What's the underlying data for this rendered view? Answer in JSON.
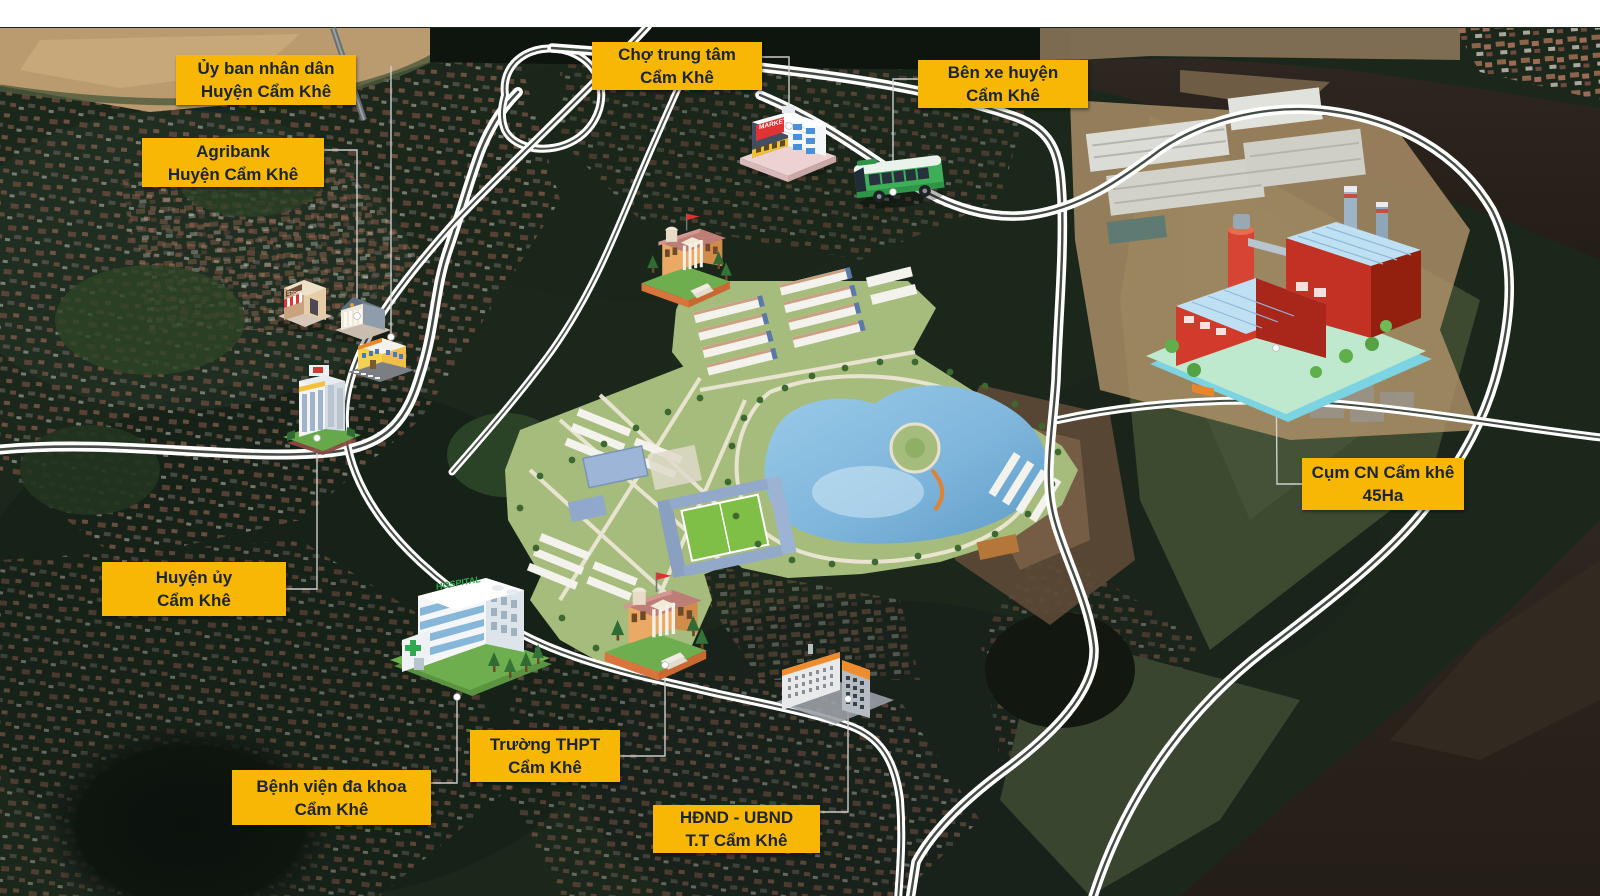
{
  "map_title": "Cẩm Khê landmarks satellite overview",
  "labels": [
    {
      "id": "uy-ban",
      "line1": "Ủy ban nhân dân",
      "line2": "Huyện Cẩm Khê"
    },
    {
      "id": "agribank",
      "line1": "Agribank",
      "line2": "Huyện Cẩm Khê"
    },
    {
      "id": "cho",
      "line1": "Chợ trung tâm",
      "line2": "Cẩm Khê"
    },
    {
      "id": "ben-xe",
      "line1": "Bên xe huyện",
      "line2": "Cẩm Khê"
    },
    {
      "id": "cum-cn",
      "line1": "Cụm CN Cẩm khê",
      "line2": "45Ha"
    },
    {
      "id": "huyen-uy",
      "line1": "Huyện ủy",
      "line2": "Cẩm Khê"
    },
    {
      "id": "benh-vien",
      "line1": "Bệnh viện đa khoa",
      "line2": "Cẩm Khê"
    },
    {
      "id": "truong",
      "line1": "Trường THPT",
      "line2": "Cẩm Khê"
    },
    {
      "id": "hdnd",
      "line1": "HĐND - UBND",
      "line2": "T.T Cẩm Khê"
    }
  ],
  "icon_texts": {
    "market": "MARKET",
    "hospital": "HOSPITAL",
    "store": "STORE"
  },
  "icons": [
    {
      "name": "store-icon"
    },
    {
      "name": "committee-building-icon"
    },
    {
      "name": "agribank-building-icon"
    },
    {
      "name": "office-tower-icon"
    },
    {
      "name": "market-building-icon"
    },
    {
      "name": "bus-icon"
    },
    {
      "name": "school-building-top-icon"
    },
    {
      "name": "factory-icon"
    },
    {
      "name": "hospital-building-icon"
    },
    {
      "name": "school-building-bottom-icon"
    },
    {
      "name": "government-office-icon"
    }
  ],
  "colors": {
    "label_bg": "#F7B704",
    "label_text": "#1B2433",
    "road": "#FFFFFF",
    "lake": "#7FB6DC",
    "masterplan_green": "#A6BC7C",
    "factory_red": "#D23B2C",
    "bus_green": "#3FAE58",
    "hospital_green": "#2FA84F"
  }
}
